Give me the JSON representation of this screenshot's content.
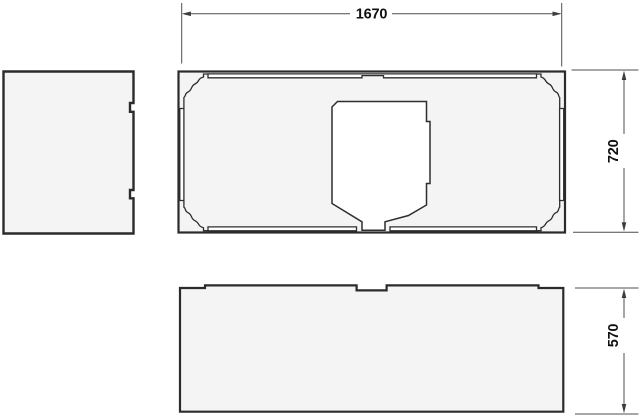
{
  "dimensions": {
    "width": {
      "label": "1670"
    },
    "depth": {
      "label": "720"
    },
    "height": {
      "label": "570"
    }
  },
  "colors": {
    "background": "#ffffff",
    "shape_fill": "#f4f4f5",
    "outline": "#2b2b2b",
    "inner_line": "#2e2e2e",
    "cutout_fill": "#ffffff",
    "dimension_line": "#4f4f4f",
    "dimension_text": "#111111"
  }
}
